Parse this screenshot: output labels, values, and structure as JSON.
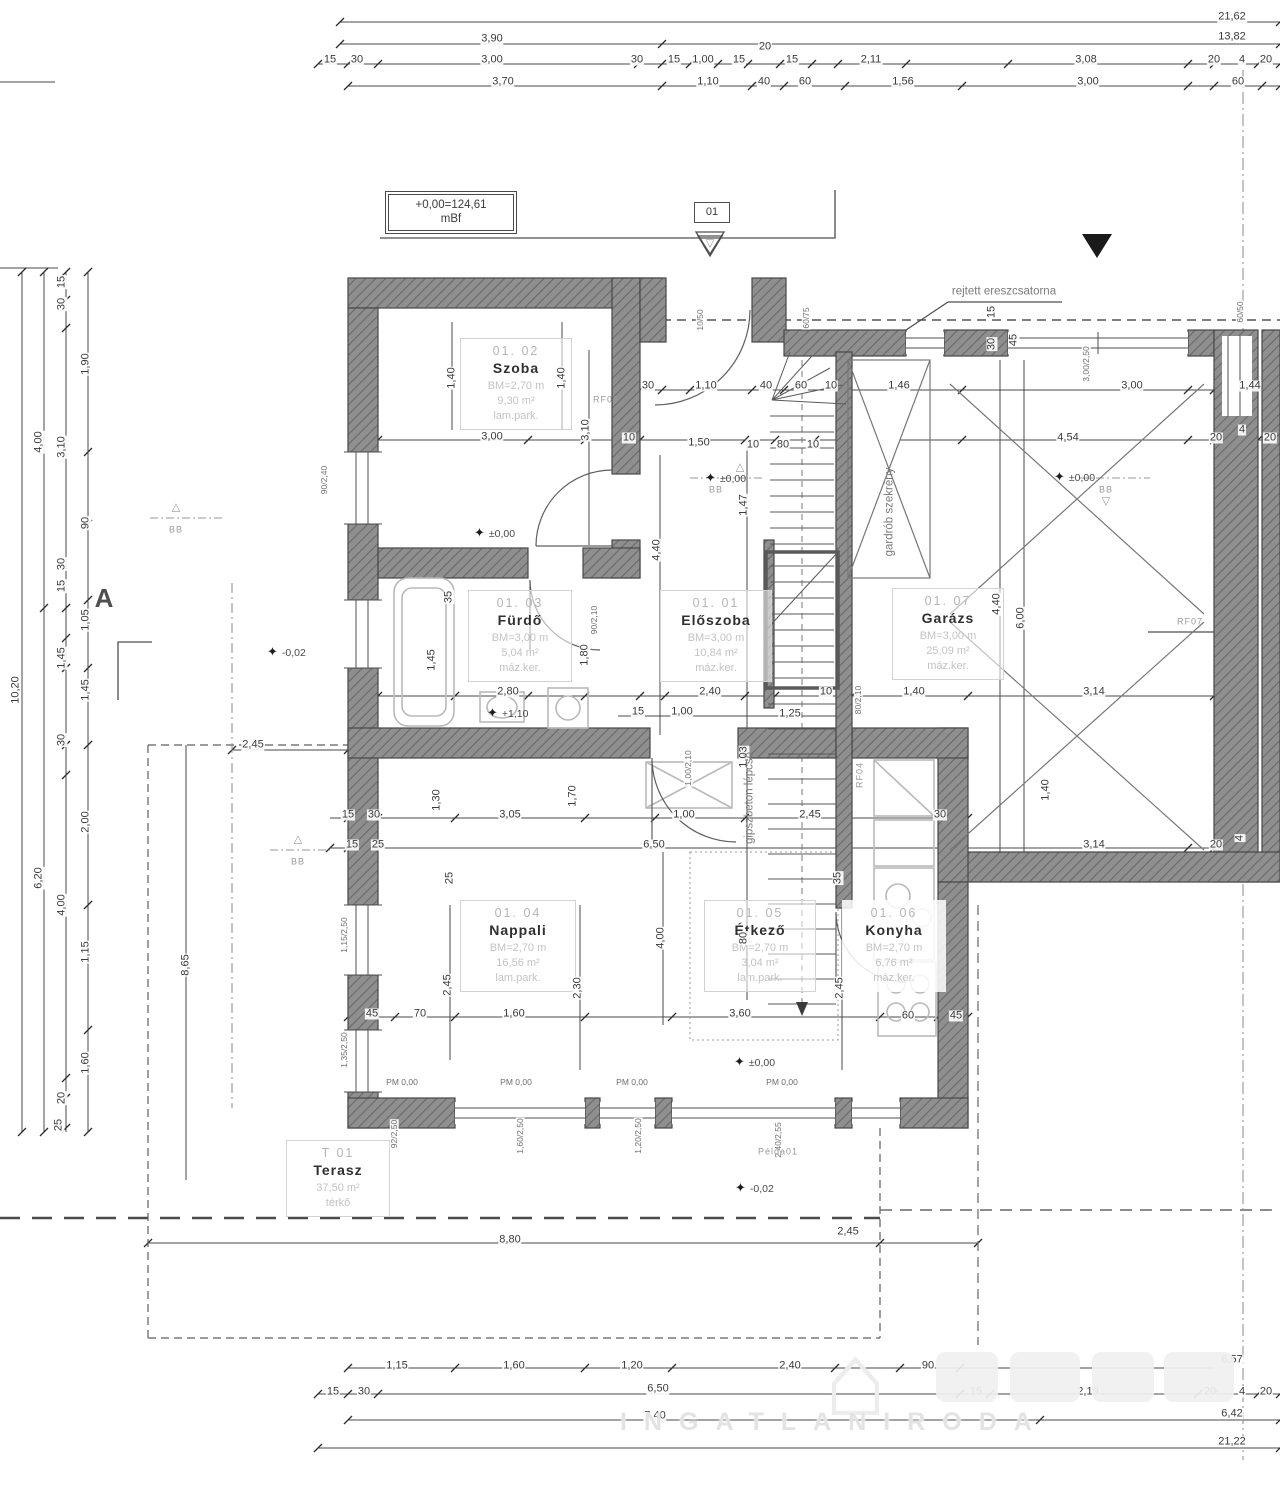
{
  "title_block": {
    "datum": "+0,00=124,61",
    "datum_unit": "mBf",
    "entry_marker": "01"
  },
  "colors": {
    "wall_fill": "#8f8f8f",
    "wall_hatch": "#6a6a6a",
    "wall_edge": "#4a4a4a",
    "line": "#3f3f3f",
    "fixture": "#b9b9b9",
    "room_meta": "#c3c3c3",
    "watermark": "#ececec"
  },
  "rooms": [
    {
      "id": "01. 02",
      "name": "Szoba",
      "height": "BM=2,70 m",
      "area": "9,30 m²",
      "floor": "lam.park."
    },
    {
      "id": "01. 03",
      "name": "Fürdő",
      "height": "BM=3,00 m",
      "area": "5,04 m²",
      "floor": "máz.ker."
    },
    {
      "id": "01. 01",
      "name": "Előszoba",
      "height": "BM=3,00 m",
      "area": "10,84 m²",
      "floor": "máz.ker."
    },
    {
      "id": "01. 07",
      "name": "Garázs",
      "height": "BM=3,00 m",
      "area": "25,09 m²",
      "floor": "máz.ker."
    },
    {
      "id": "01. 04",
      "name": "Nappali",
      "height": "BM=2,70 m",
      "area": "16,56 m²",
      "floor": "lam.park."
    },
    {
      "id": "01. 05",
      "name": "Étkező",
      "height": "BM=2,70 m",
      "area": "3,04 m²",
      "floor": "lam.park."
    },
    {
      "id": "01. 06",
      "name": "Konyha",
      "height": "BM=2,70 m",
      "area": "6,76 m²",
      "floor": "máz.ker."
    },
    {
      "id": "T 01",
      "name": "Terasz",
      "height": "",
      "area": "37,50 m²",
      "floor": "térkő"
    }
  ],
  "watermark": {
    "subtitle": "INGATLANIRODA",
    "logo": "house-logo"
  },
  "dim_labels": [
    [
      "21,62",
      1232,
      17
    ],
    [
      "3,90",
      492,
      39
    ],
    [
      "13,82",
      1232,
      37
    ],
    [
      "20",
      765,
      47
    ],
    [
      "15",
      330,
      60
    ],
    [
      "30",
      357,
      60
    ],
    [
      "3,00",
      492,
      60
    ],
    [
      "30",
      637,
      60
    ],
    [
      "15",
      674,
      60
    ],
    [
      "1,00",
      703,
      60
    ],
    [
      "15",
      739,
      60
    ],
    [
      "15",
      792,
      60
    ],
    [
      "2,11",
      871,
      60
    ],
    [
      "3,08",
      1086,
      60
    ],
    [
      "20",
      1214,
      60
    ],
    [
      "4",
      1242,
      60
    ],
    [
      "20",
      1266,
      60
    ],
    [
      "3,70",
      503,
      82
    ],
    [
      "1,10",
      708,
      82
    ],
    [
      "40",
      764,
      82
    ],
    [
      "60",
      805,
      82
    ],
    [
      "1,56",
      903,
      82
    ],
    [
      "3,00",
      1088,
      82
    ],
    [
      "60",
      1238,
      82
    ],
    [
      "10,20",
      16,
      690,
      1
    ],
    [
      "4,00",
      39,
      442,
      1
    ],
    [
      "6,20",
      39,
      878,
      1
    ],
    [
      "15",
      62,
      282,
      1
    ],
    [
      "30",
      62,
      304,
      1
    ],
    [
      "3,10",
      62,
      447,
      1
    ],
    [
      "30",
      62,
      564,
      1
    ],
    [
      "15",
      62,
      586,
      1
    ],
    [
      "1,45",
      62,
      658,
      1
    ],
    [
      "30",
      62,
      740,
      1
    ],
    [
      "4,00",
      62,
      905,
      1
    ],
    [
      "20",
      62,
      1098,
      1
    ],
    [
      "25",
      59,
      1125,
      1
    ],
    [
      "1,90",
      86,
      364,
      1
    ],
    [
      "90",
      86,
      523,
      1
    ],
    [
      "1,05",
      86,
      620,
      1
    ],
    [
      "1,45",
      86,
      690,
      1
    ],
    [
      "2,00",
      86,
      822,
      1
    ],
    [
      "1,15",
      86,
      952,
      1
    ],
    [
      "1,60",
      86,
      1063,
      1
    ],
    [
      "8,65",
      186,
      965,
      1
    ],
    [
      "1,15",
      397,
      1366
    ],
    [
      "1,60",
      514,
      1366
    ],
    [
      "1,20",
      632,
      1366
    ],
    [
      "2,40",
      790,
      1366
    ],
    [
      "90",
      928,
      1366
    ],
    [
      "6,57",
      1232,
      1360
    ],
    [
      "15",
      333,
      1392
    ],
    [
      "30",
      364,
      1392
    ],
    [
      "6,50",
      658,
      1389
    ],
    [
      "15",
      976,
      1392
    ],
    [
      "2,19",
      1088,
      1392
    ],
    [
      "20",
      1210,
      1392
    ],
    [
      "4",
      1242,
      1392
    ],
    [
      "20",
      1266,
      1392
    ],
    [
      "7,40",
      655,
      1416
    ],
    [
      "6,42",
      1232,
      1414
    ],
    [
      "21,22",
      1232,
      1442
    ],
    [
      "8,80",
      510,
      1240
    ],
    [
      "2,45",
      848,
      1232
    ],
    [
      "2,45",
      253,
      745
    ],
    [
      "30",
      648,
      386
    ],
    [
      "1,10",
      706,
      386
    ],
    [
      "40",
      766,
      386
    ],
    [
      "60",
      801,
      386
    ],
    [
      "10",
      831,
      386
    ],
    [
      "1,46",
      899,
      386
    ],
    [
      "3,00",
      1132,
      386
    ],
    [
      "1,44",
      1250,
      386
    ],
    [
      "1,40",
      452,
      378,
      1
    ],
    [
      "1,40",
      562,
      378,
      1
    ],
    [
      "3,00",
      492,
      437
    ],
    [
      "3,10",
      586,
      430,
      1
    ],
    [
      "10",
      629,
      438
    ],
    [
      "1,50",
      699,
      443
    ],
    [
      "10",
      753,
      445
    ],
    [
      "80",
      783,
      445
    ],
    [
      "10",
      813,
      445
    ],
    [
      "4,54",
      1068,
      438
    ],
    [
      "20",
      1216,
      438
    ],
    [
      "4",
      1242,
      430
    ],
    [
      "20",
      1270,
      438
    ],
    [
      "10/50",
      700,
      320,
      1
    ],
    [
      "60/75",
      806,
      318,
      1
    ],
    [
      "60/50",
      1240,
      312,
      1
    ],
    [
      "3,00/2,50",
      1086,
      364,
      1
    ],
    [
      "90/2,40",
      324,
      480,
      1
    ],
    [
      "15",
      992,
      312,
      1
    ],
    [
      "30",
      992,
      344,
      1
    ],
    [
      "45",
      1014,
      340,
      1
    ],
    [
      "35",
      449,
      597,
      1
    ],
    [
      "1,45",
      432,
      660,
      1
    ],
    [
      "1,80",
      585,
      655,
      1
    ],
    [
      "2,80",
      508,
      692
    ],
    [
      "90/2,10",
      594,
      620,
      1
    ],
    [
      "1,47",
      744,
      505,
      1
    ],
    [
      "4,40",
      657,
      550,
      1
    ],
    [
      "4,40",
      997,
      604,
      1
    ],
    [
      "6,00",
      1021,
      618,
      1
    ],
    [
      "1,03",
      744,
      757,
      1
    ],
    [
      "80",
      744,
      938,
      1
    ],
    [
      "2,40",
      710,
      692
    ],
    [
      "1,00",
      682,
      712
    ],
    [
      "15",
      638,
      712
    ],
    [
      "1,25",
      790,
      714
    ],
    [
      "10",
      826,
      692
    ],
    [
      "80/2,10",
      858,
      700,
      1
    ],
    [
      "1,40",
      914,
      692
    ],
    [
      "3,14",
      1094,
      692
    ],
    [
      "15",
      348,
      815
    ],
    [
      "30",
      374,
      815
    ],
    [
      "1,30",
      437,
      800,
      1
    ],
    [
      "3,05",
      510,
      815
    ],
    [
      "1,70",
      573,
      796,
      1
    ],
    [
      "1,00",
      684,
      815
    ],
    [
      "2,45",
      810,
      815
    ],
    [
      "30",
      940,
      815
    ],
    [
      "15",
      352,
      845
    ],
    [
      "25",
      378,
      845
    ],
    [
      "6,50",
      654,
      845
    ],
    [
      "3,14",
      1094,
      845
    ],
    [
      "20",
      1216,
      845
    ],
    [
      "4",
      1240,
      838,
      1
    ],
    [
      "1,40",
      1046,
      790,
      1
    ],
    [
      "1,00/2,10",
      688,
      768,
      1
    ],
    [
      "2,45",
      448,
      985,
      1
    ],
    [
      "2,30",
      578,
      988,
      1
    ],
    [
      "4,00",
      661,
      938,
      1
    ],
    [
      "2,45",
      840,
      988,
      1
    ],
    [
      "35",
      838,
      878,
      1
    ],
    [
      "25",
      450,
      878,
      1
    ],
    [
      "45",
      372,
      1014
    ],
    [
      "70",
      420,
      1014
    ],
    [
      "1,60",
      514,
      1014
    ],
    [
      "3,60",
      740,
      1014
    ],
    [
      "60",
      908,
      1016
    ],
    [
      "45",
      956,
      1016
    ],
    [
      "PM 0,00",
      402,
      1082
    ],
    [
      "PM 0,00",
      516,
      1082
    ],
    [
      "PM 0,00",
      632,
      1082
    ],
    [
      "PM 0,00",
      782,
      1082
    ],
    [
      "92/2,50",
      394,
      1134,
      1
    ],
    [
      "1,15/2,50",
      344,
      935,
      1
    ],
    [
      "1,35/2,50",
      344,
      1050,
      1
    ],
    [
      "1,60/2,50",
      520,
      1136,
      1
    ],
    [
      "1,20/2,50",
      638,
      1136,
      1
    ],
    [
      "2,40/2,55",
      778,
      1140,
      1
    ]
  ],
  "spot_levels": [
    [
      "±0,00",
      492,
      533
    ],
    [
      "±0,00",
      723,
      478
    ],
    [
      "±0,00",
      1072,
      477
    ],
    [
      "+1,10",
      505,
      713
    ],
    [
      "-0,02",
      285,
      652
    ],
    [
      "-0,02",
      753,
      1188
    ],
    [
      "±0,00",
      752,
      1062
    ]
  ],
  "annotations": [
    [
      "rejtett ereszcsatorna",
      1004,
      292,
      "note",
      0
    ],
    [
      "gipszbeton lépcső",
      750,
      798,
      "note",
      1
    ],
    [
      "gardrób szekrény",
      890,
      512,
      "note",
      1
    ],
    [
      "Példa01",
      778,
      1152,
      "tinyg",
      0
    ],
    [
      "RF03",
      606,
      400,
      "tinyg",
      0
    ],
    [
      "RF04",
      860,
      775,
      "tinyg",
      1
    ],
    [
      "RF07",
      1190,
      622,
      "tinyg",
      0
    ],
    [
      "A",
      104,
      598,
      "secA",
      0
    ],
    [
      "BB",
      176,
      530,
      "tinyg",
      0
    ],
    [
      "BB",
      298,
      862,
      "tinyg",
      0
    ],
    [
      "BB",
      716,
      490,
      "tinyg",
      0
    ],
    [
      "BB",
      1106,
      490,
      "tinyg",
      0
    ],
    [
      "△",
      176,
      508,
      "tri",
      0
    ],
    [
      "△",
      298,
      840,
      "tri",
      0
    ],
    [
      "△",
      740,
      468,
      "tri",
      0
    ],
    [
      "▽",
      1106,
      502,
      "tri",
      0
    ],
    [
      "▽",
      710,
      244,
      "tri",
      0
    ]
  ]
}
